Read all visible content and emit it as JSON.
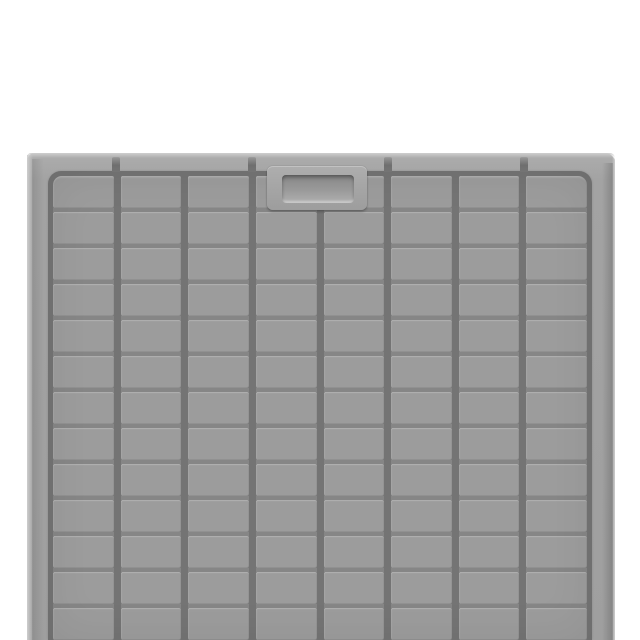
{
  "image": {
    "alt": "Light gray molded plastic panel with embossed rectangular grid pattern, recessed handle pocket near the top center, photographed on a white background",
    "background_color": "#ffffff"
  },
  "panel": {
    "rim_color": "#a3a3a3",
    "face_color": "#9c9c9c",
    "groove_color": "#747474",
    "edge_highlight_color": "#cecece",
    "grid": {
      "columns": 8,
      "rows": 13,
      "cell_color": "#9c9c9c"
    },
    "notches": {
      "count": 4,
      "x_centers": [
        116,
        252,
        388,
        524
      ],
      "color": "#6f6f6f"
    },
    "handle": {
      "plateau_color": "#a6a6a6",
      "pocket_top_color": "#878787",
      "pocket_bottom_color": "#b0b0b0"
    }
  }
}
